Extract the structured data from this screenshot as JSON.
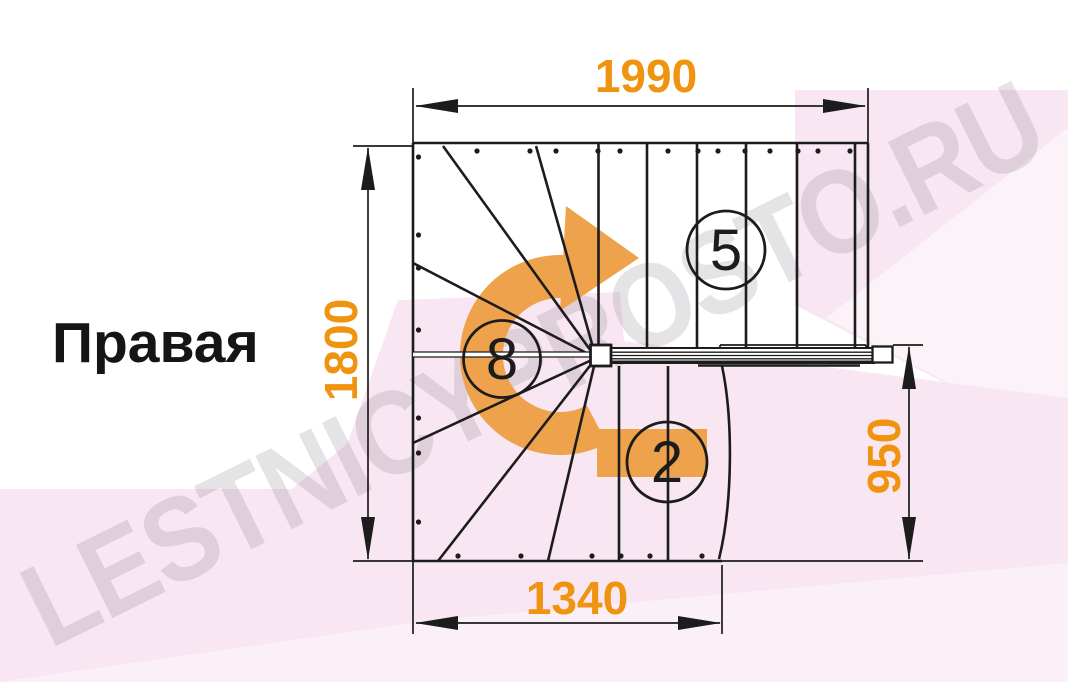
{
  "title": {
    "label": "Правая"
  },
  "dimensions": {
    "top_width": "1990",
    "left_height": "1800",
    "right_height": "950",
    "bottom_width": "1340"
  },
  "steps": {
    "upper_flight_count": "5",
    "winder_count": "8",
    "lower_flight_count": "2"
  },
  "watermark": {
    "text": "LESTNICYPROSTO.RU"
  },
  "colors": {
    "dimension_orange": "#f0930e",
    "arrow_orange": "#efa24c",
    "line_black": "#1c1c1c",
    "background_pink": "#f8e7f2",
    "watermark_gray": "rgba(125,115,128,0.20)"
  }
}
